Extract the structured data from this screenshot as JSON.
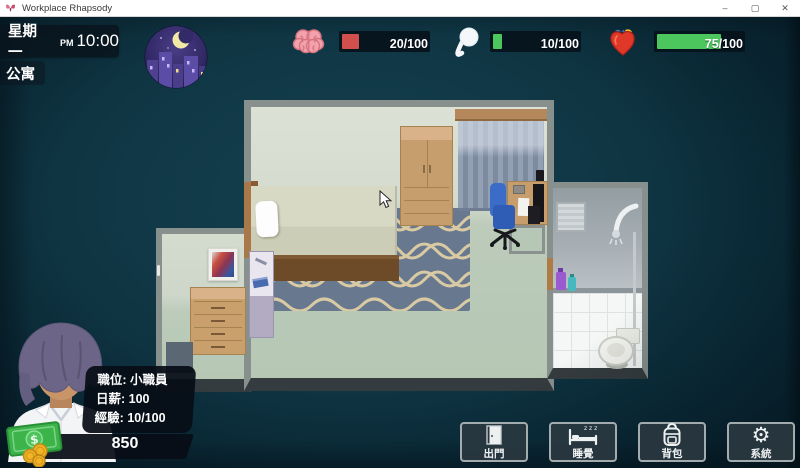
{
  "window": {
    "title": "Workplace Rhapsody",
    "controls": {
      "minimize": "–",
      "maximize": "▢",
      "close": "✕"
    }
  },
  "hud": {
    "day": "星期一",
    "meridiem": "PM",
    "time": "10:00",
    "location": "公寓",
    "time_of_day_icon": "moon-night-city",
    "stats": [
      {
        "name": "mood",
        "icon": "brain-icon",
        "value": 20,
        "max": 100,
        "display": "20/100",
        "fill": "#d1504e"
      },
      {
        "name": "energy",
        "icon": "spirit-icon",
        "value": 10,
        "max": 100,
        "display": "10/100",
        "fill": "#4cc75e"
      },
      {
        "name": "health",
        "icon": "heart-icon",
        "value": 75,
        "max": 100,
        "display": "75/100",
        "fill": "#4cc75e"
      }
    ]
  },
  "player": {
    "portrait": "young-man-purple-hair",
    "currency_symbol": "$",
    "money": "850",
    "info": [
      {
        "label": "職位:",
        "value": "小職員"
      },
      {
        "label": "日薪:",
        "value": "100"
      },
      {
        "label": "經驗:",
        "value": "10/100"
      }
    ]
  },
  "actions": [
    {
      "label": "出門",
      "icon": "door-icon"
    },
    {
      "label": "睡覺",
      "icon": "bed-icon",
      "icon_accent": "z z z"
    },
    {
      "label": "背包",
      "icon": "backpack-icon"
    },
    {
      "label": "系統",
      "icon": "gear-icon",
      "glyph": "⚙"
    }
  ],
  "scene": {
    "name": "apartment-interior",
    "rooms": [
      "bedroom",
      "entry-alcove",
      "bathroom"
    ],
    "furniture": [
      "bed",
      "pillow",
      "wardrobe",
      "curtain",
      "desk",
      "computer-monitor",
      "office-chair",
      "chair-mat",
      "rug",
      "side-shelf",
      "dresser",
      "wall-painting",
      "floor-mat",
      "bathroom-window",
      "shower",
      "shampoo-bottles",
      "toilet"
    ]
  },
  "colors": {
    "bar_red": "#d1504e",
    "bar_green": "#4cc75e",
    "panel_dark": "#0a141e",
    "bg_center": "#15414f",
    "bg_edge": "#082330",
    "button_bg": "#2a3840",
    "button_border": "#a2acae",
    "wall_gray": "#87908d"
  }
}
